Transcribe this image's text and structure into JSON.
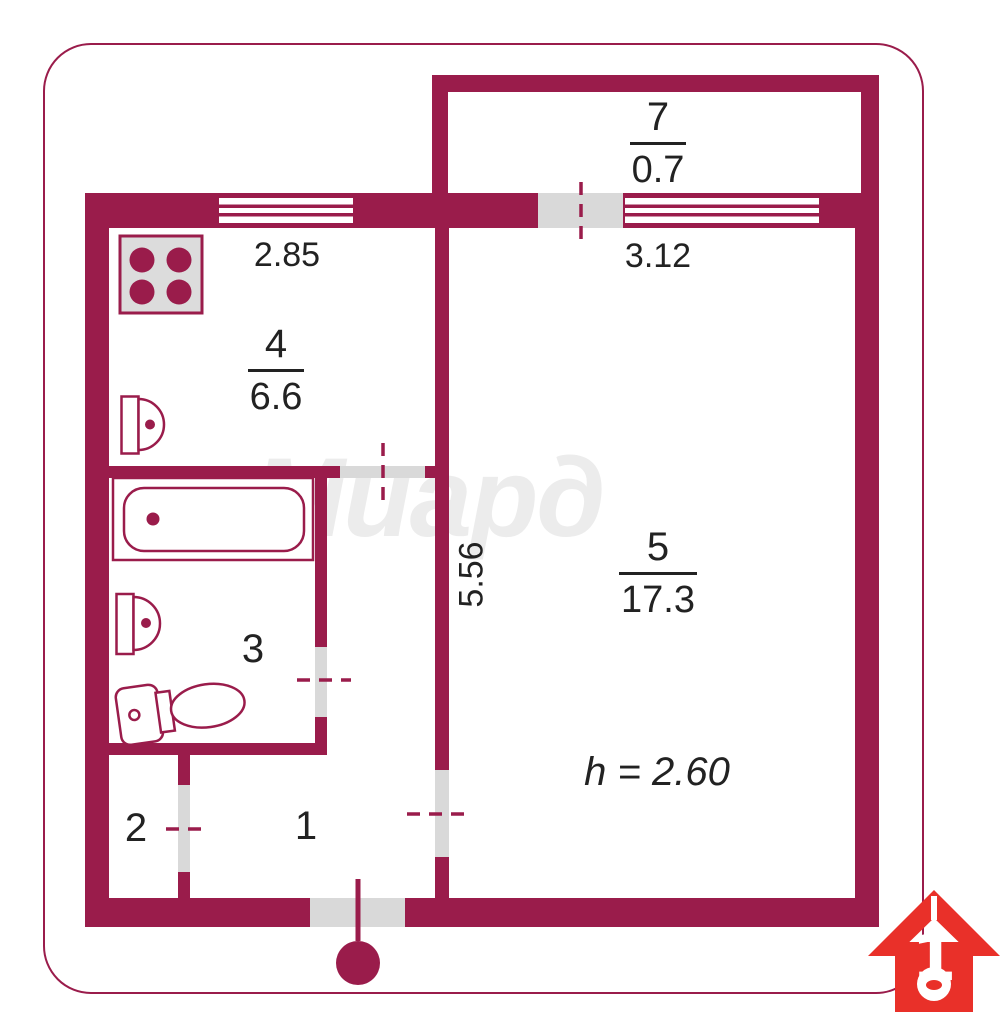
{
  "colors": {
    "wall": "#9a1c4b",
    "door_grey": "#d9d9d9",
    "fixture_grey": "#dcdcdc",
    "text": "#222222",
    "logo_red": "#e93029",
    "watermark_grey": "#ececec"
  },
  "watermark": "Миард",
  "rooms": {
    "balcony": {
      "number": "7",
      "area": "0.7"
    },
    "kitchen": {
      "number": "4",
      "area": "6.6"
    },
    "living": {
      "number": "5",
      "area": "17.3"
    },
    "bathroom": {
      "number": "3"
    },
    "closet": {
      "number": "2"
    },
    "hall": {
      "number": "1"
    }
  },
  "dimensions": {
    "kitchen_width": "2.85",
    "living_width": "3.12",
    "living_depth": "5.56",
    "ceiling_height": "h = 2.60"
  },
  "logo": {
    "digit": "1"
  }
}
